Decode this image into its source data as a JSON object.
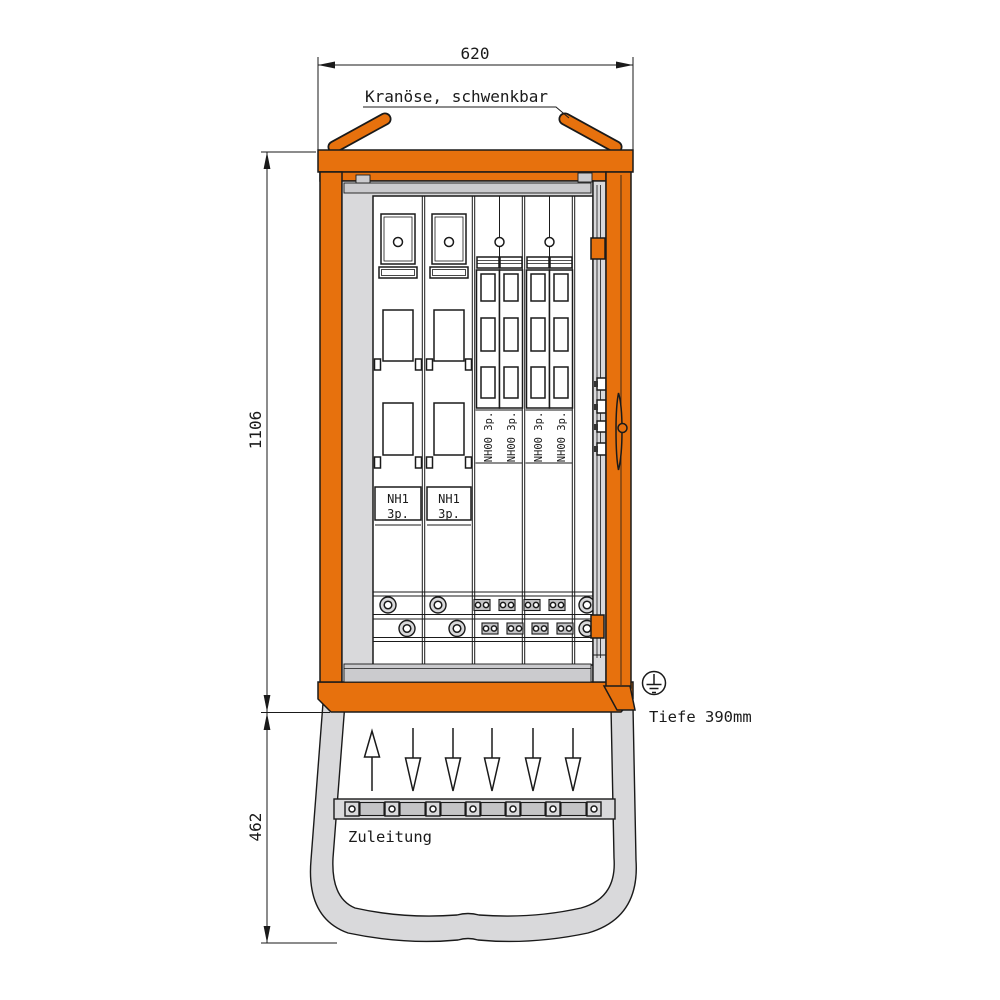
{
  "drawing": {
    "labels": {
      "crane": "Kranöse, schwenkbar",
      "supply": "Zuleitung",
      "depth": "Tiefe 390mm"
    },
    "dimensions": {
      "width": "620",
      "body_height": "1106",
      "base_height": "462"
    },
    "components": {
      "nh1_name": "NH1",
      "nh1_poles": "3p.",
      "nh00_label": "NH00 3p."
    },
    "colors": {
      "cabinet_orange": "#E7710D",
      "panel_gray": "#D9D9DB",
      "line": "#1A1A1A"
    }
  }
}
